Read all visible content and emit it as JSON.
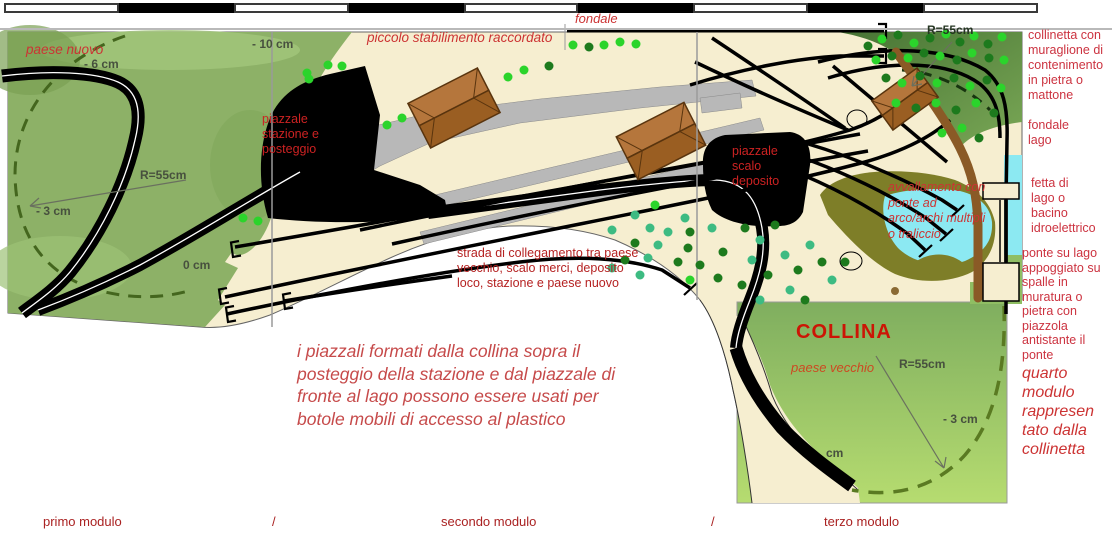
{
  "scale_bar": {
    "segments": 9
  },
  "labels": {
    "paese_nuovo": "paese nuovo",
    "minus6": "- 6 cm",
    "minus10": "- 10 cm",
    "fondale_top": "fondale",
    "piccolo_stabilimento": "piccolo stabilimento raccordato",
    "piazzale_stazione": "piazzale\nstazione e\nposteggio",
    "r55_left": "R=55cm",
    "minus3_left": "- 3 cm",
    "zero_cm": "0 cm",
    "piazzale_scalo": "piazzale\nscalo\ndeposito",
    "r55_topright": "R=55cm",
    "strada": "strada di collegamento tra paese\nvecchio, scalo merci, deposito\nloco, stazione e paese nuovo",
    "avvallamento": "avvallamento con\nponte ad\narco/archi multipli\no traliccio",
    "collina": "COLLINA",
    "paese_vecchio": "paese vecchio",
    "r55_collina": "R=55cm",
    "minus3_collina": "- 3 cm",
    "cm_fragment": "cm",
    "big_note": "i piazzali formati dalla collina sopra il\nposteggio della stazione e dal piazzale di\nfronte al lago possono essere usati per\nbotole mobili di accesso al plastico"
  },
  "right_margin": {
    "collinetta": "collinetta con\nmuraglione di\ncontenimento\nin pietra o\nmattone",
    "fondale_lago": "fondale\nlago",
    "fetta": "fetta di\nlago o\nbacino\nidroelettrico",
    "ponte": "ponte su lago\nappoggiato su\nspalle in\nmuratura o\npietra con\npiazzola\nantistante il\nponte",
    "quarto": "quarto\nmodulo\nrappresen\ntato dalla\ncollinetta"
  },
  "bottom": {
    "primo": "primo modulo",
    "slash1": "/",
    "secondo": "secondo modulo",
    "slash2": "/",
    "terzo": "terzo modulo"
  },
  "map": {
    "tree_colors": [
      "#2bd42b",
      "#1d7a1d",
      "#3dbb82"
    ],
    "trees": [
      [
        573,
        45,
        0
      ],
      [
        589,
        47,
        1
      ],
      [
        604,
        45,
        0
      ],
      [
        620,
        42,
        0
      ],
      [
        636,
        44,
        0
      ],
      [
        508,
        77,
        0
      ],
      [
        524,
        70,
        0
      ],
      [
        549,
        66,
        1
      ],
      [
        307,
        73,
        0
      ],
      [
        328,
        65,
        0
      ],
      [
        342,
        66,
        0
      ],
      [
        309,
        79,
        0
      ],
      [
        387,
        125,
        0
      ],
      [
        402,
        118,
        0
      ],
      [
        243,
        218,
        0
      ],
      [
        258,
        221,
        0
      ],
      [
        868,
        46,
        1
      ],
      [
        882,
        39,
        0
      ],
      [
        898,
        35,
        1
      ],
      [
        914,
        43,
        0
      ],
      [
        930,
        38,
        1
      ],
      [
        946,
        34,
        0
      ],
      [
        960,
        42,
        1
      ],
      [
        974,
        36,
        0
      ],
      [
        988,
        44,
        1
      ],
      [
        1002,
        37,
        0
      ],
      [
        876,
        60,
        0
      ],
      [
        892,
        56,
        1
      ],
      [
        908,
        58,
        0
      ],
      [
        924,
        53,
        1
      ],
      [
        940,
        56,
        0
      ],
      [
        957,
        60,
        1
      ],
      [
        972,
        53,
        0
      ],
      [
        989,
        58,
        1
      ],
      [
        1004,
        60,
        0
      ],
      [
        886,
        78,
        1
      ],
      [
        902,
        83,
        0
      ],
      [
        920,
        76,
        1
      ],
      [
        937,
        83,
        0
      ],
      [
        954,
        78,
        1
      ],
      [
        970,
        86,
        0
      ],
      [
        987,
        80,
        1
      ],
      [
        1001,
        88,
        0
      ],
      [
        896,
        103,
        0
      ],
      [
        916,
        108,
        1
      ],
      [
        936,
        103,
        0
      ],
      [
        956,
        110,
        1
      ],
      [
        976,
        103,
        0
      ],
      [
        994,
        113,
        1
      ],
      [
        962,
        128,
        0
      ],
      [
        979,
        138,
        1
      ],
      [
        942,
        133,
        0
      ],
      [
        635,
        215,
        2
      ],
      [
        655,
        205,
        0
      ],
      [
        685,
        218,
        2
      ],
      [
        650,
        228,
        2
      ],
      [
        612,
        230,
        2
      ],
      [
        635,
        243,
        1
      ],
      [
        668,
        232,
        2
      ],
      [
        690,
        232,
        1
      ],
      [
        712,
        228,
        2
      ],
      [
        658,
        245,
        2
      ],
      [
        688,
        248,
        1
      ],
      [
        625,
        260,
        1
      ],
      [
        648,
        258,
        2
      ],
      [
        678,
        262,
        1
      ],
      [
        640,
        275,
        2
      ],
      [
        612,
        268,
        2
      ],
      [
        690,
        280,
        0
      ],
      [
        718,
        278,
        1
      ],
      [
        723,
        252,
        1
      ],
      [
        700,
        265,
        1
      ],
      [
        745,
        228,
        1
      ],
      [
        760,
        240,
        2
      ],
      [
        775,
        225,
        1
      ],
      [
        752,
        260,
        2
      ],
      [
        768,
        275,
        1
      ],
      [
        785,
        255,
        2
      ],
      [
        798,
        270,
        1
      ],
      [
        810,
        245,
        2
      ],
      [
        822,
        262,
        1
      ],
      [
        790,
        290,
        2
      ],
      [
        805,
        300,
        1
      ],
      [
        760,
        300,
        2
      ],
      [
        742,
        285,
        1
      ],
      [
        832,
        280,
        2
      ],
      [
        845,
        262,
        1
      ]
    ]
  }
}
